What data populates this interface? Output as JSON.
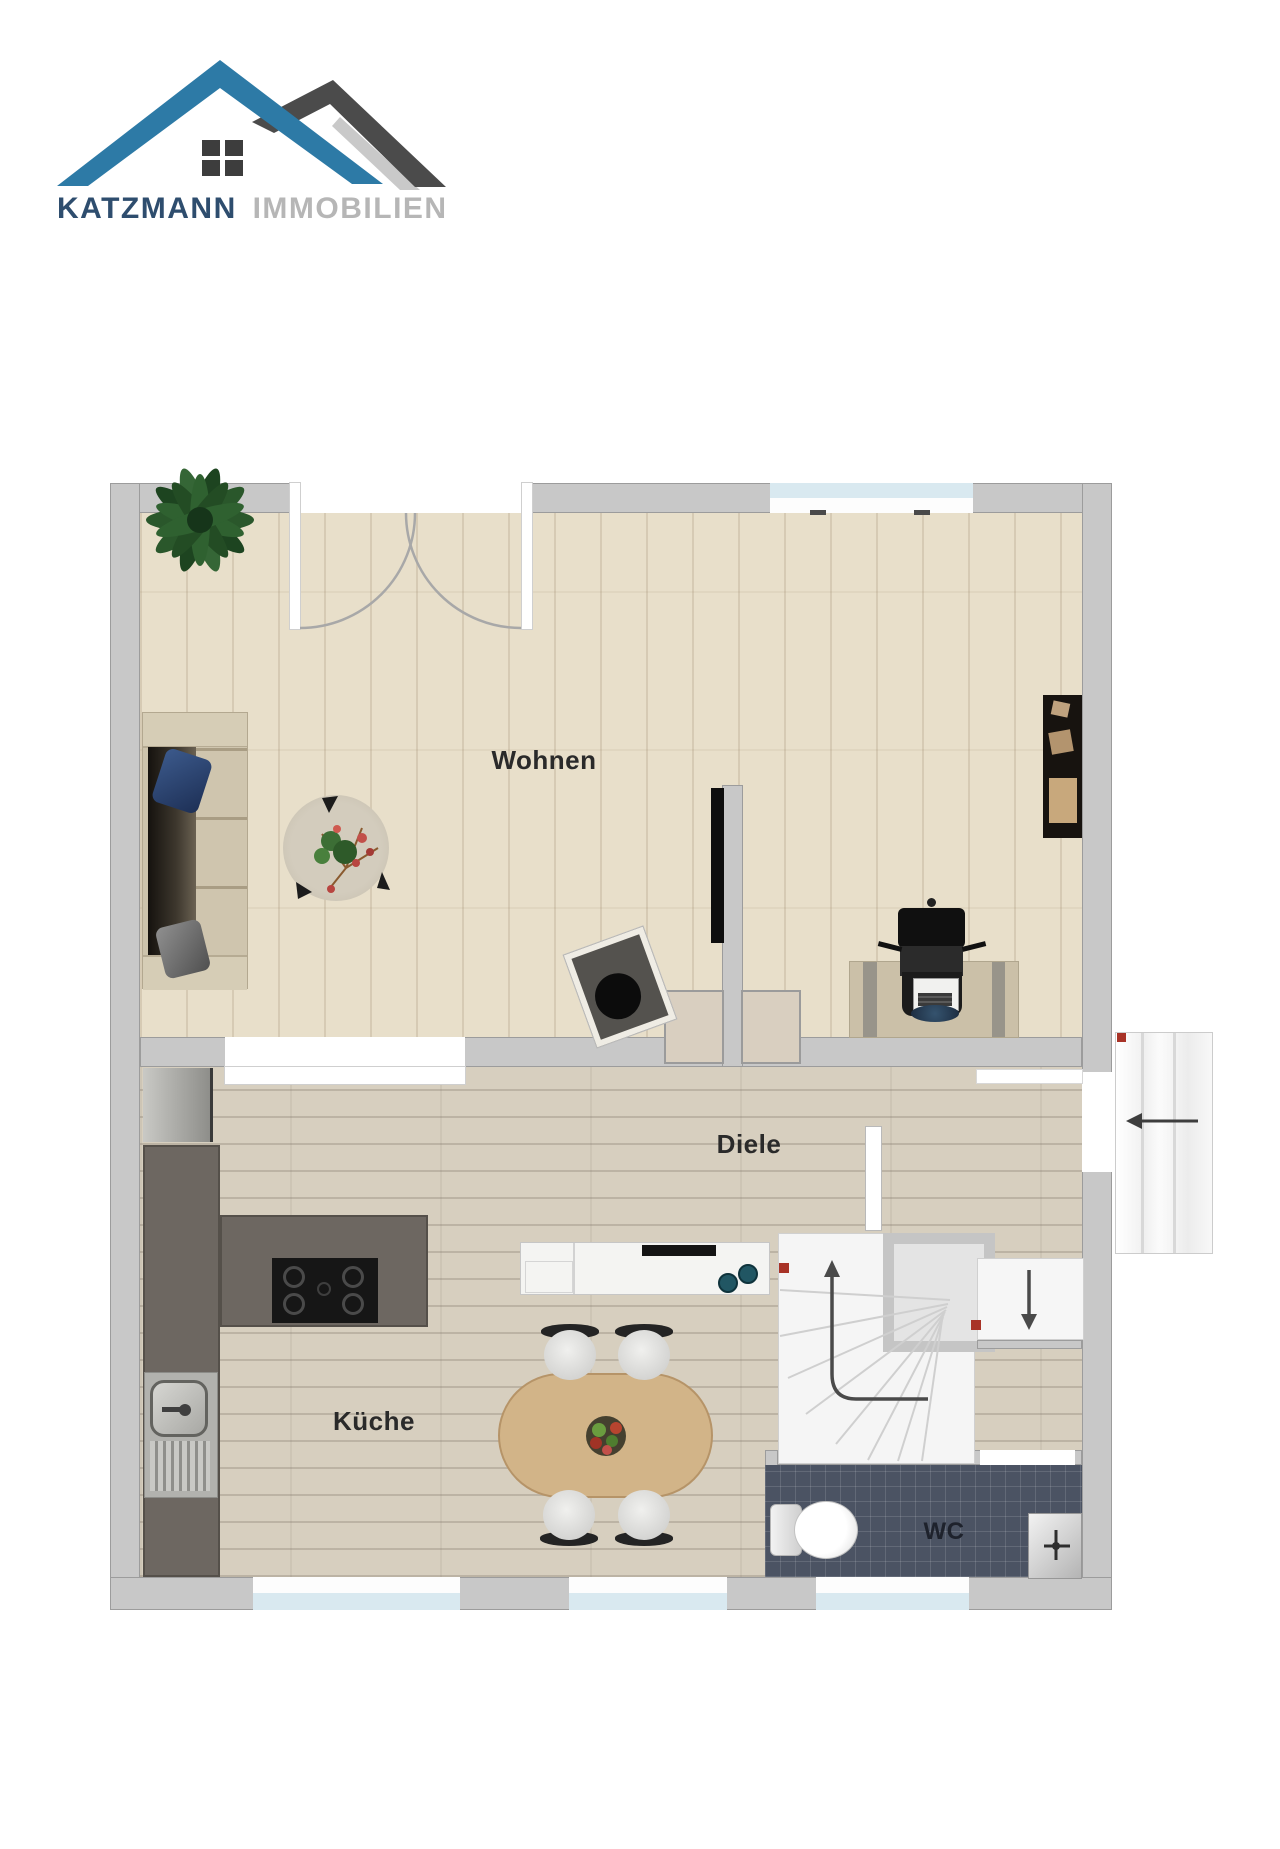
{
  "logo": {
    "brand": "KATZMANN",
    "suffix": "IMMOBILIEN",
    "brand_color": "#2e4d6e",
    "suffix_color": "#b6b6b6",
    "roof_blue": "#2d7aa6",
    "roof_gray": "#4b4b4b"
  },
  "rooms": {
    "wohnen": "Wohnen",
    "diele": "Diele",
    "kueche": "Küche",
    "wc": "WC"
  },
  "colors": {
    "wall": "#c8c8c8",
    "floor_living": "#e8dfca",
    "floor_hall": "#d7cfbf",
    "wc_tile": "#4b5363",
    "window_glass": "#d9e9f0",
    "marker_red": "#a83327",
    "counter_dark": "#6d6761",
    "table_wood": "#d2b488"
  }
}
